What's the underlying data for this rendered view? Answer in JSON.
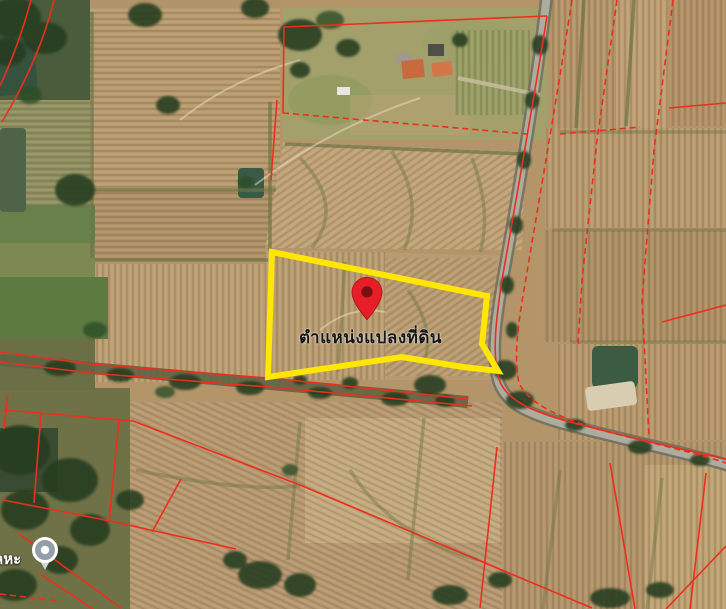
{
  "map": {
    "view_type": "satellite",
    "plot_label": "ตำแหน่งแปลงที่ดิน",
    "partial_place_label": "ลหะ",
    "markers": {
      "location_pin": "red map pin marking the land plot",
      "poi_marker": "gray point-of-interest balloon"
    },
    "colors": {
      "plot_outline": "#ffe605",
      "parcel_line": "#ee2e1c",
      "pin_fill": "#e61e28",
      "pin_inner": "#7a1013",
      "road_gray": "#adad9f",
      "field_tan": "#b49569"
    }
  }
}
